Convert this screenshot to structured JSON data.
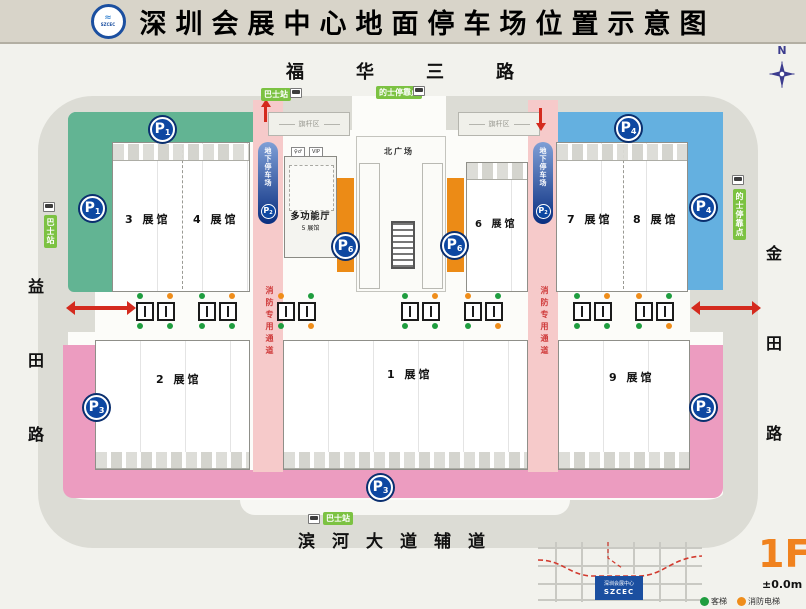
{
  "title": {
    "text": "深圳会展中心地面停车场位置示意图",
    "logo": "SZCEC"
  },
  "compass": {
    "north": "N"
  },
  "roads": {
    "top": "福华三路",
    "bottom": "滨河大道辅道",
    "left": "益田路",
    "right": "金田路"
  },
  "halls": {
    "h1": "1 展馆",
    "h2": "2 展馆",
    "h3": "3 展馆",
    "h4": "4 展馆",
    "h6": "6 展馆",
    "h7": "7 展馆",
    "h8": "8 展馆",
    "h9": "9 展馆",
    "multi": "多功能厅",
    "multi_sub": "5 展馆"
  },
  "labels": {
    "north_plaza": "北广场",
    "underground_parking": "地下停车场",
    "fire_lane": "消防专用通道",
    "bus_stop": "巴士站",
    "taxi_stop": "的士停靠点",
    "flag_area": "旗杆区",
    "vip": "VIP",
    "restroom": "♀♂"
  },
  "parking": {
    "letter": "P",
    "zone1": "1",
    "zone2": "2",
    "zone3": "3",
    "zone4": "4",
    "zone6": "6"
  },
  "inset": {
    "building_cn": "深圳会展中心",
    "building_en": "SZCEC",
    "floor": "1F",
    "elevation": "±0.0m",
    "legend_passenger": "客梯",
    "legend_fire": "消防电梯"
  },
  "colors": {
    "p1_area": "#62b493",
    "p4_area": "#64b0e0",
    "p3_area": "#ec9cc0",
    "fire_lane": "#f6caca",
    "vip_dock": "#ec8b16",
    "parking_blue": "#0d47a1",
    "floor_orange": "#f0821e",
    "station_green": "#7cc242"
  }
}
